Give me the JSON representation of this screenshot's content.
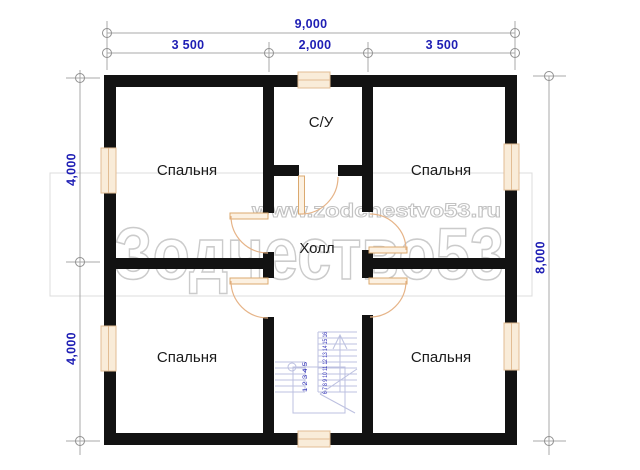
{
  "plan": {
    "title": "second floor plan",
    "watermark": {
      "url_text": "www.zodchestvo53.ru",
      "brand_text": "Зодчество53"
    },
    "dimensions": {
      "top_total": "9,000",
      "top_segments": [
        "3 500",
        "2,000",
        "3 500"
      ],
      "left_upper": "4,000",
      "left_lower": "4,000",
      "right_total": "8,000"
    },
    "rooms": {
      "bedroom_top_left": "Спальня",
      "bedroom_top_right": "Спальня",
      "bedroom_bottom_left": "Спальня",
      "bedroom_bottom_right": "Спальня",
      "bathroom": "С/У",
      "hall": "Холл"
    },
    "stairs": {
      "flight_right_numbers": "6 7 8 9 10 11 12 13 14 15 16",
      "flight_left_numbers": "1 2 3 4 5"
    },
    "colors": {
      "wall": "#121212",
      "dim_text": "#1e1eb4",
      "dim_line": "#a8a8a8",
      "window_fill": "#f9ecd9",
      "window_frame": "#e2bd94",
      "door": "#e6b488",
      "stairs": "#bcc0e0",
      "watermark": "#cbcbcb"
    }
  }
}
